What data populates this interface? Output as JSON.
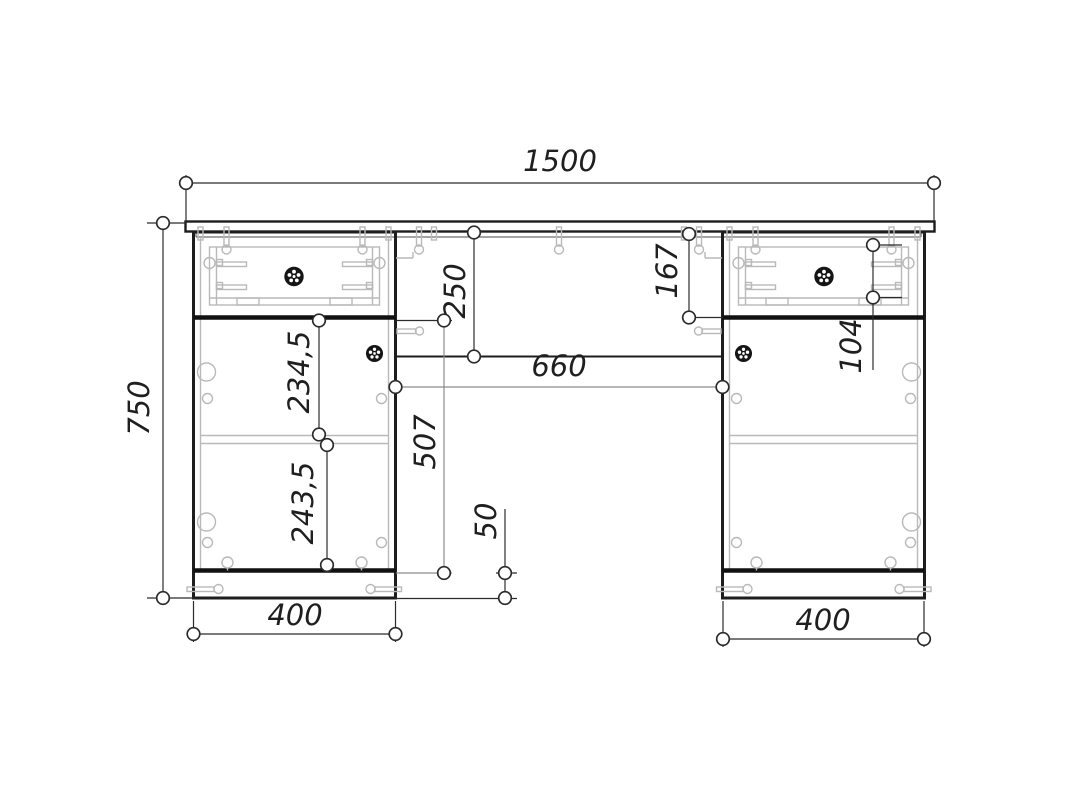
{
  "drawing": {
    "background": "#ffffff",
    "line_color": "#1d1d1d",
    "hidden_line_color": "#b9b9b9",
    "dimension_color": "#2b2b2b"
  },
  "labels": {
    "overall_width": "1500",
    "overall_height": "750",
    "left_pedestal_width": "400",
    "right_pedestal_width": "400",
    "center_opening_width": "660",
    "back_panel_height": "250",
    "upper_door_section": "234,5",
    "lower_door_section": "243,5",
    "below_drawer_height": "507",
    "plinth_height": "50",
    "right_back_offset": "167",
    "drawer_box_height": "104"
  }
}
